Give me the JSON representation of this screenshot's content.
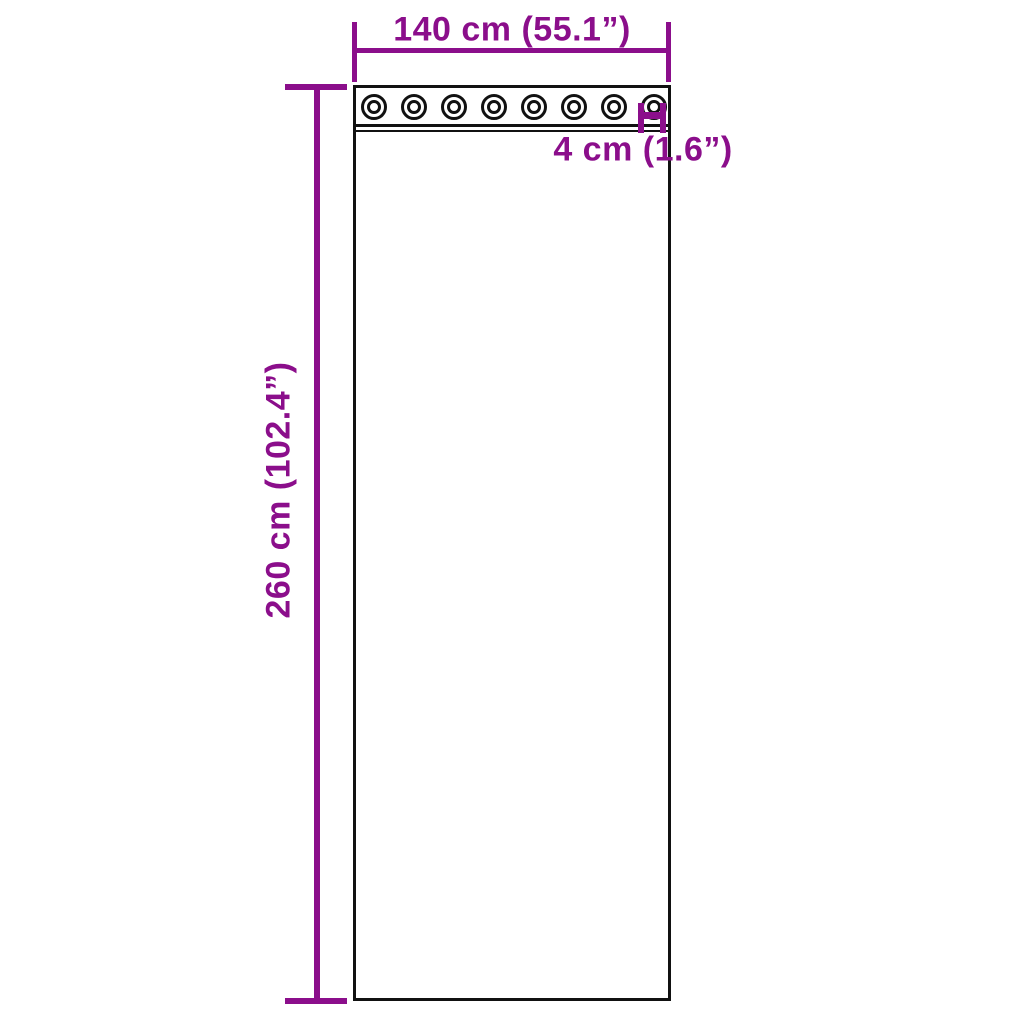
{
  "labels": {
    "width": "140 cm (55.1”)",
    "height": "260 cm (102.4”)",
    "grommet_diameter": "4 cm (1.6”)"
  },
  "grommets": {
    "count": 8
  },
  "colors": {
    "dimension": "#8B0E8B",
    "outline": "#111111",
    "background": "#FFFFFF"
  }
}
